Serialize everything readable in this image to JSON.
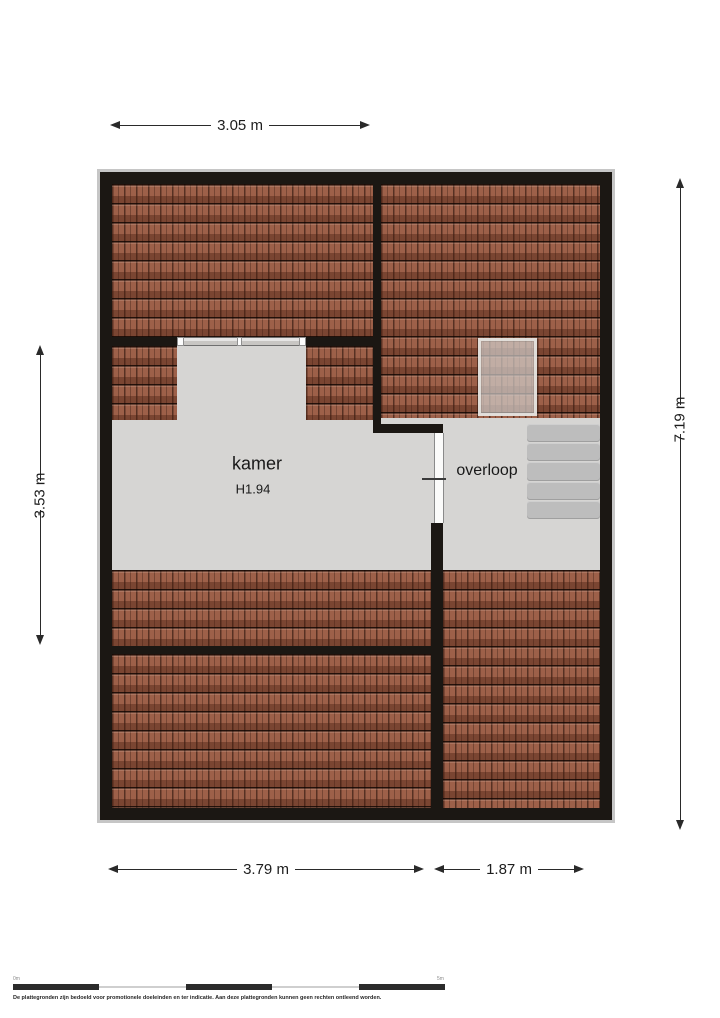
{
  "plan": {
    "rooms": {
      "kamer": {
        "name": "kamer",
        "height_label": "H1.94"
      },
      "overloop": {
        "name": "overloop"
      }
    },
    "dimensions": {
      "top": "3.05 m",
      "left": "3.53 m",
      "right": "7.19 m",
      "bottom_left": "3.79 m",
      "bottom_right": "1.87 m"
    }
  },
  "scalebar": {
    "start_label": "0m",
    "end_label": "5m"
  },
  "footer": {
    "disclaimer": "De plattegronden zijn bedoeld voor promotionele doeleinden en ter indicatie. Aan deze plattegronden kunnen geen rechten ontleend worden."
  },
  "colors": {
    "wall": "#1b1713",
    "roof_tile": "#9d6049",
    "floor": "#d6d5d3",
    "stair_tread": "#bdbdbd",
    "dim_text": "#1d1d1d",
    "outline": "#c6c6c6"
  }
}
